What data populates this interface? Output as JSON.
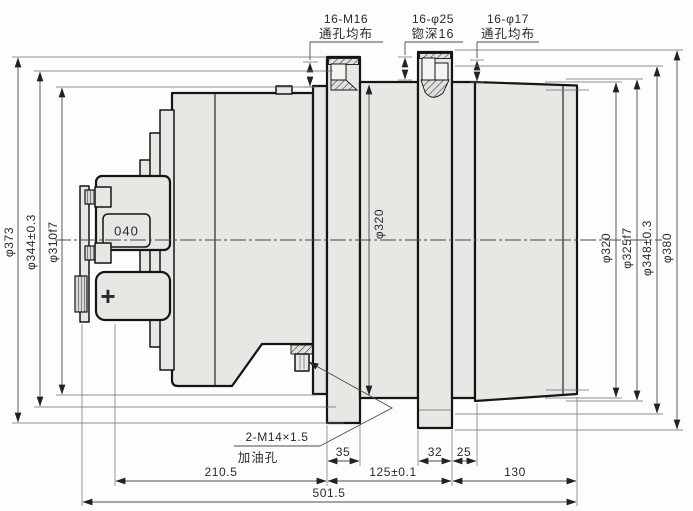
{
  "colors": {
    "background": "#fdfdfd",
    "part_fill": "#e7e7e4",
    "outline": "#151515",
    "dimension": "#4a4a4a"
  },
  "top_callouts": [
    {
      "title": "16-M16",
      "note": "通孔均布"
    },
    {
      "title": "16-φ25",
      "note": "锪深16"
    },
    {
      "title": "16-φ17",
      "note": "通孔均布"
    }
  ],
  "left_dims": [
    "φ373",
    "φ344±0.3",
    "φ310f7"
  ],
  "center_dim": "φ320",
  "right_dims": [
    "φ320",
    "φ325f7",
    "φ348±0.3",
    "φ380"
  ],
  "oil_callout": {
    "title": "2-M14×1.5",
    "note": "加油孔"
  },
  "bottom_dims": {
    "flange1_width": "35",
    "flange2_width": "32",
    "spacer_width": "25",
    "left_length": "210.5",
    "mid_length": "125±0.1",
    "right_length": "130",
    "total_length": "501.5"
  },
  "markings": {
    "part_code": "040",
    "plug_cross": "+"
  }
}
